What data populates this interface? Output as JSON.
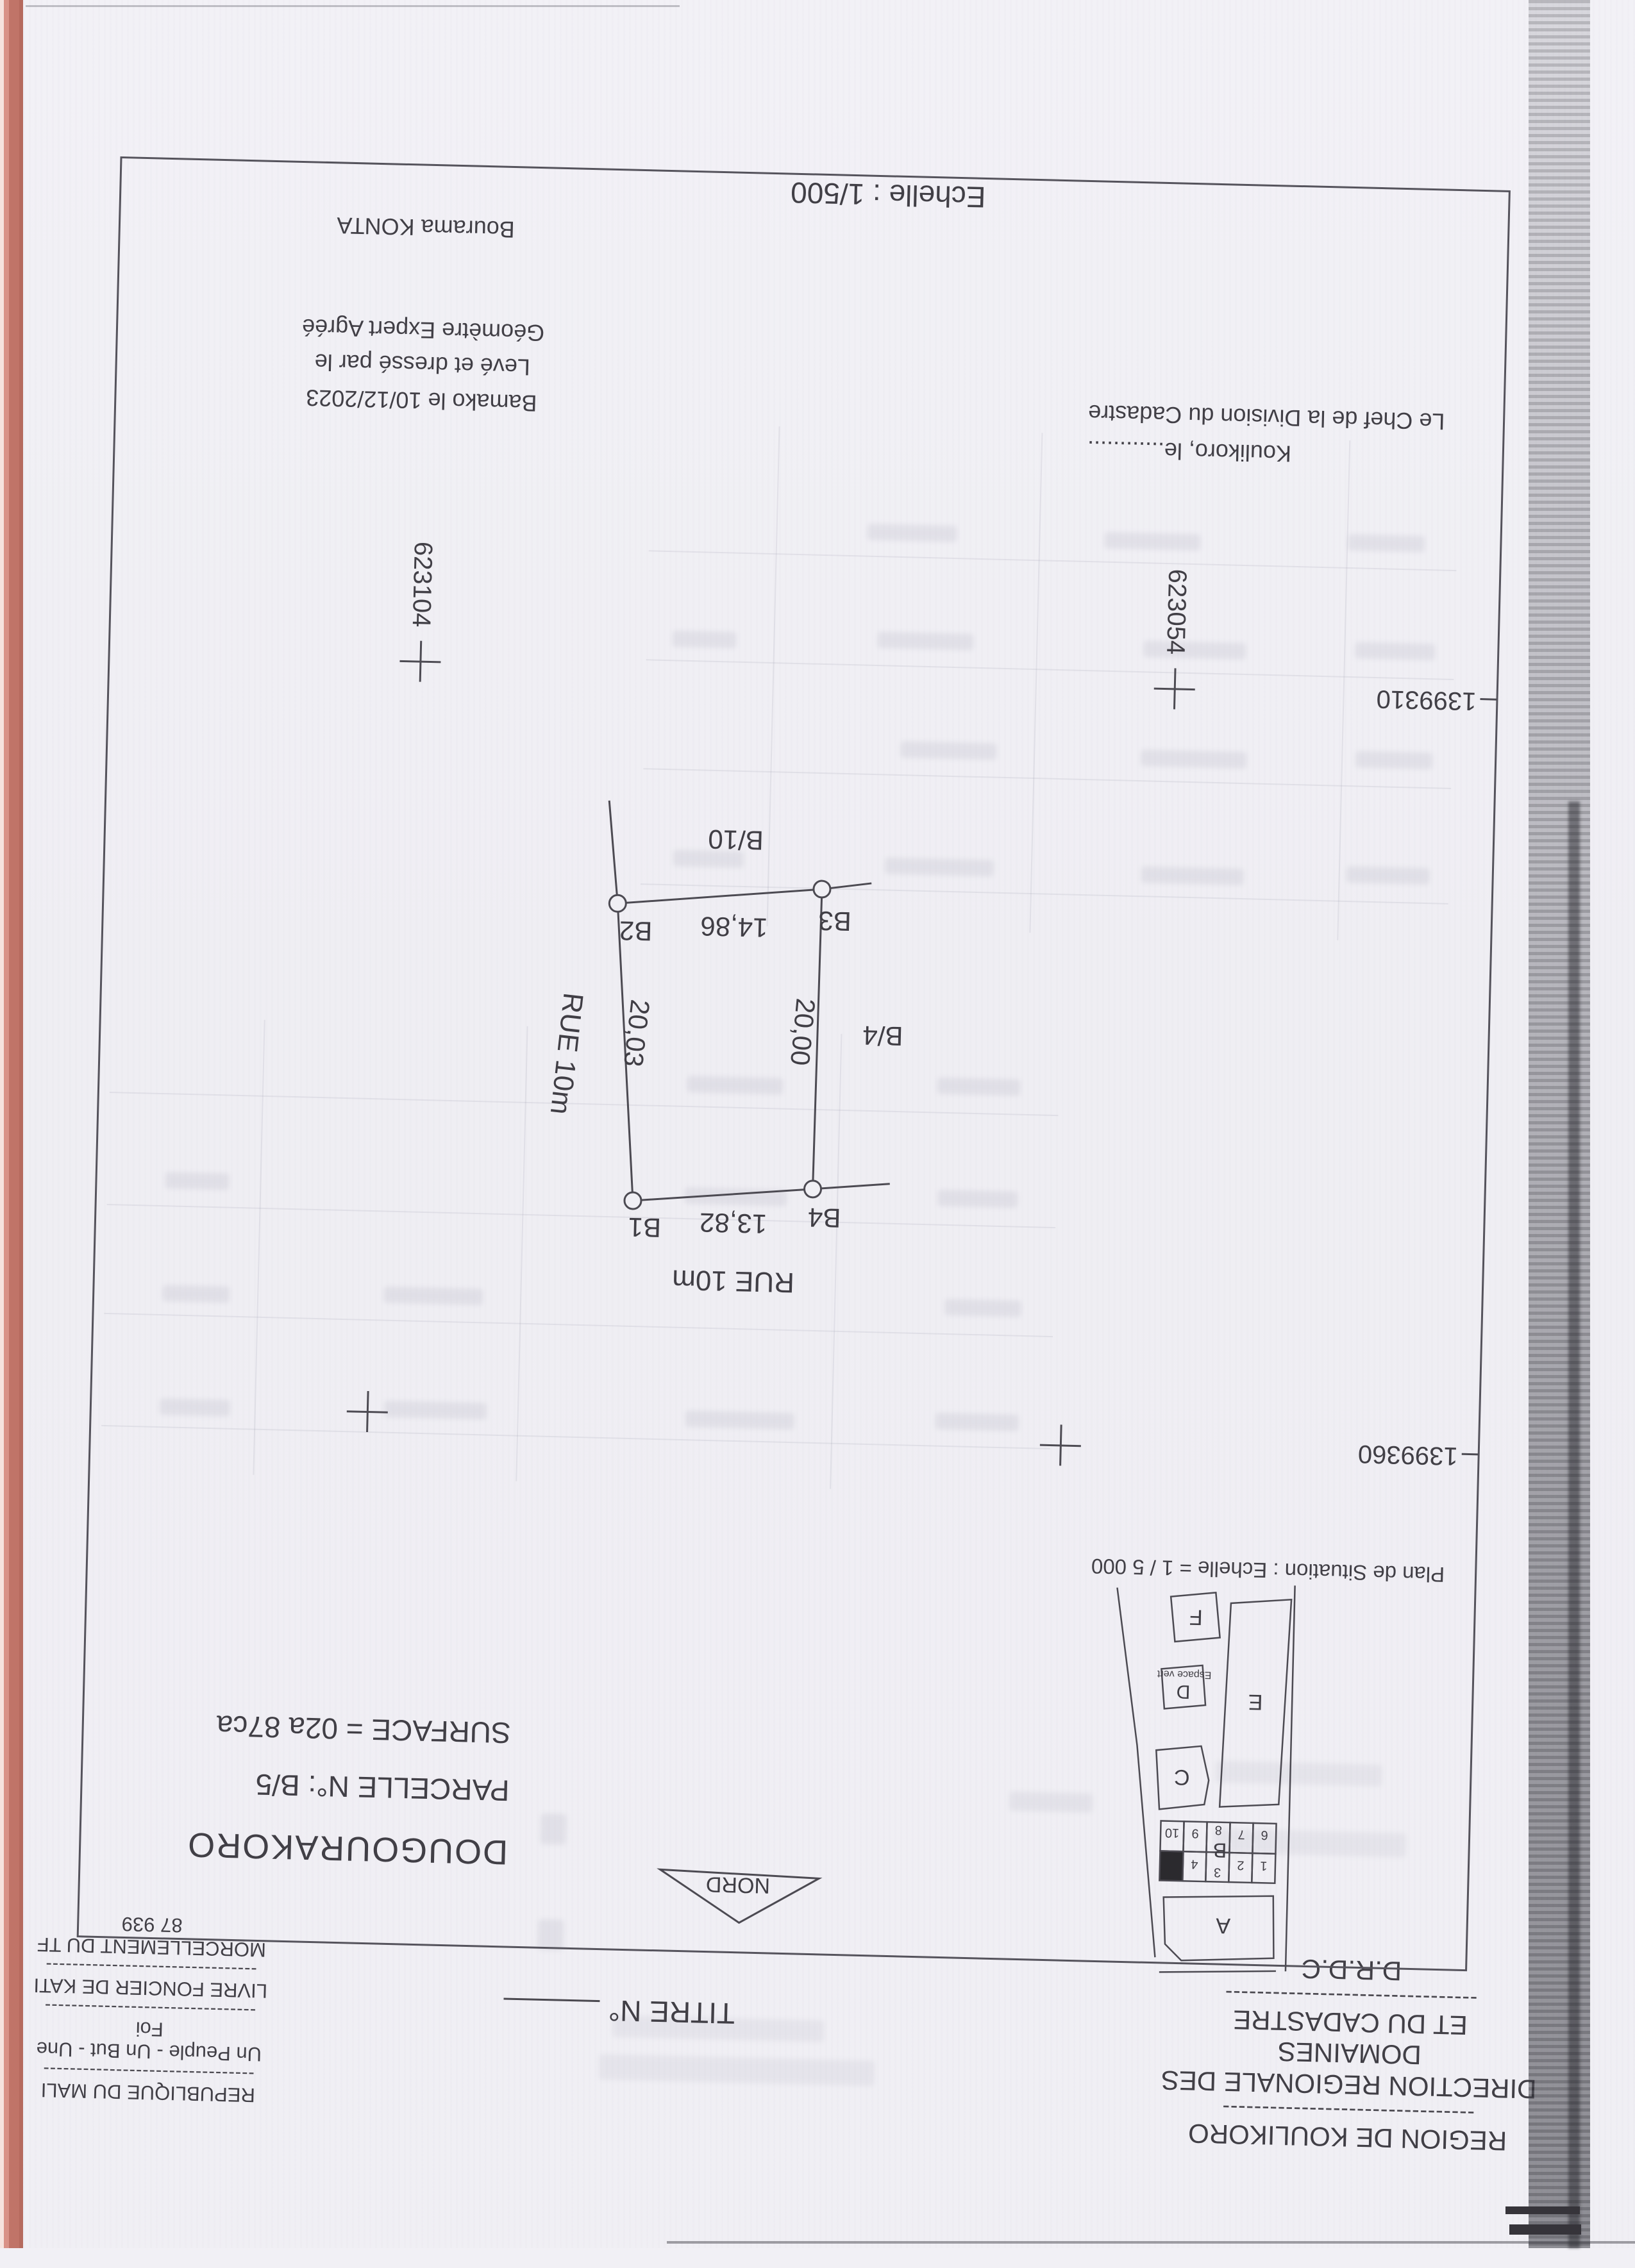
{
  "header": {
    "left": {
      "line1": "REGION DE KOULIKORO",
      "line2": "DIRECTION REGIONALE DES DOMAINES",
      "line3": "ET DU CADASTRE",
      "line4": "D.R.D.C",
      "sep": "--------------------------------"
    },
    "center": {
      "title": "TITRE N°"
    },
    "right": {
      "line1": "REPUBLIQUE DU MALI",
      "line2": "Un Peuple - Un But - Une Foi",
      "line3": "LIVRE FONCIER DE KATI",
      "line4": "MORCELLEMENT DU TF 87 939",
      "sep": "--------------------------------"
    }
  },
  "north": {
    "label": "NORD"
  },
  "situation": {
    "caption": "Plan de Situation : Echelle = 1 / 5 000",
    "blocks": {
      "a": "A",
      "b": "B",
      "c": "C",
      "d": "D",
      "e": "E",
      "f": "F",
      "espace": "Espace vert"
    },
    "lots_row1": [
      "1",
      "2",
      "3",
      "4"
    ],
    "lots_row2": [
      "6",
      "7",
      "8",
      "9",
      "10"
    ]
  },
  "parcel_info": {
    "locality": "DOUGOURAKORO",
    "parcel": "PARCELLE N°: B/5",
    "surface": "SURFACE = 02a 87ca"
  },
  "plan": {
    "street_top": "RUE 10m",
    "street_right": "RUE 10m",
    "neighbor_left": "B/4",
    "neighbor_bottom": "B/10",
    "top_v1": "B4",
    "top_len": "13,82",
    "top_v2": "B1",
    "bottom_v1": "B3",
    "bottom_len": "14,86",
    "bottom_v2": "B2",
    "left_len": "20,00",
    "right_len": "20,03"
  },
  "grid": {
    "x_east": "623104",
    "x_west": "623054",
    "y_south": "1399310",
    "y_north": "1399360"
  },
  "sign_left": {
    "line1": "Koulikoro, le............",
    "line2": "Le Chef de la Division du Cadastre"
  },
  "sign_right": {
    "line1": "Bamako le 10/12/2023",
    "line2": "Levé et dressé par le",
    "line3": "Géomètre Expert Agréé",
    "name": "Bourama KONTA"
  },
  "scale": {
    "label": "Echelle : 1/500"
  },
  "colors": {
    "ink": "#413f46",
    "paper": "#f0eff4",
    "edge_pink": "#c07468",
    "highlight_parcel": "#2b2a2e"
  }
}
